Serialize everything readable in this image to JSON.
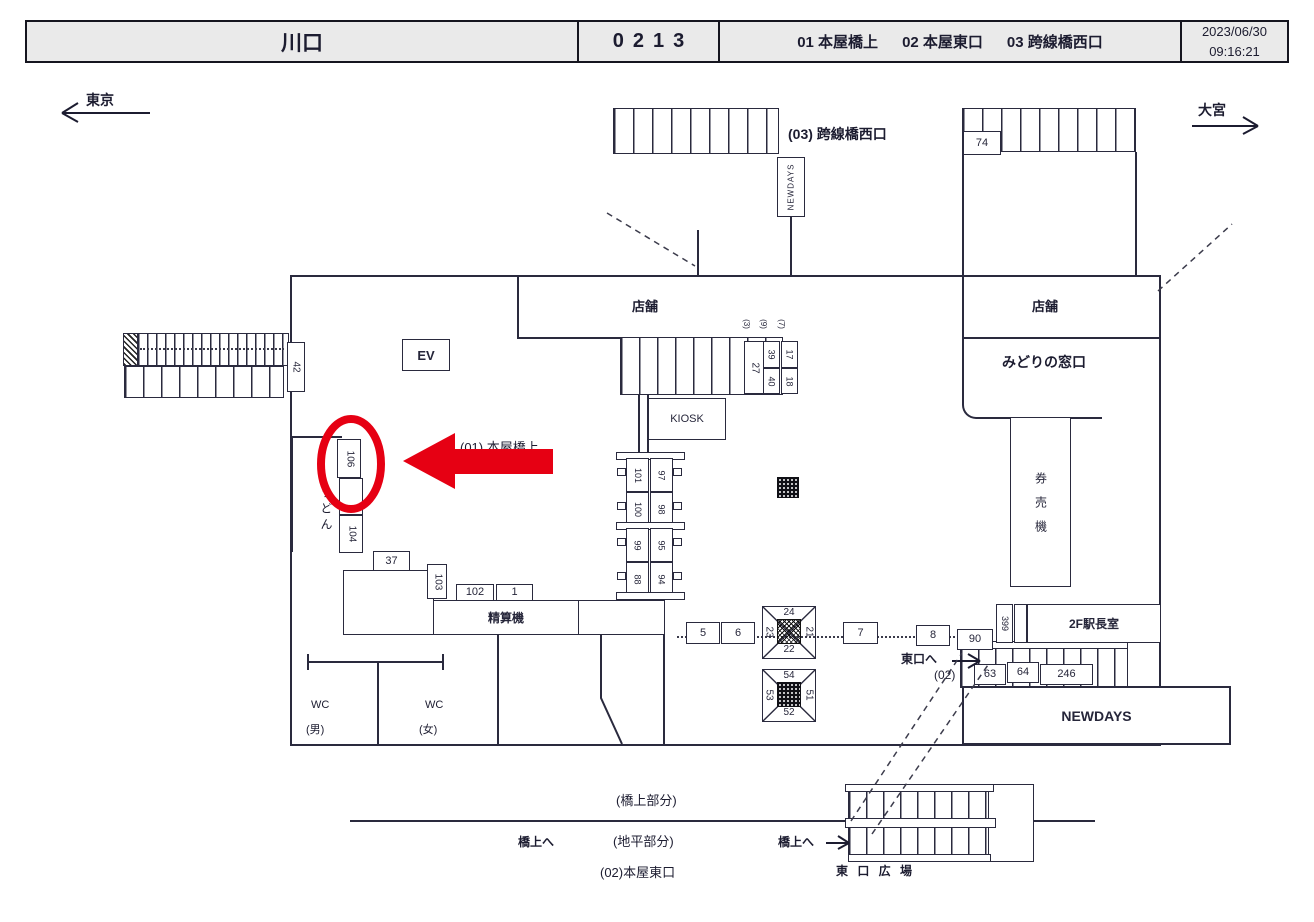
{
  "header": {
    "station": "川口",
    "code": "0213",
    "areas": [
      "01 本屋橋上",
      "02 本屋東口",
      "03 跨線橋西口"
    ],
    "date": "2023/06/30",
    "time": "09:16:21"
  },
  "directions": {
    "left": "東京",
    "right": "大宮"
  },
  "labels": {
    "kosenkyo": "(03) 跨線橋西口",
    "honya": "(01) 本屋橋上",
    "shop_left": "店舗",
    "shop_right": "店舗",
    "midori": "みどりの窓口",
    "kenbaiki": "券売機",
    "kiosk": "KIOSK",
    "ev": "EV",
    "seisanki": "精算機",
    "newdays_top": "NEWDAYS",
    "newdays_main": "NEWDAYS",
    "ekicho": "2F駅長室",
    "udon": "うどん",
    "wc": "WC",
    "wc_male": "(男)",
    "wc_female": "(女)",
    "to_east": "東口へ",
    "to_east_code": "(02)",
    "bridge_part": "(橋上部分)",
    "ground_part": "(地平部分)",
    "honya_east": "(02)本屋東口",
    "to_bridge": "橋上へ",
    "east_plaza": "東 口 広 場"
  },
  "signs": {
    "s42": "42",
    "s74": "74",
    "s106": "106",
    "s104": "104",
    "s37": "37",
    "s103": "103",
    "s102": "102",
    "s1": "1",
    "s27": "27",
    "s39": "39",
    "s40": "40",
    "s17": "17",
    "s18": "18",
    "s101": "101",
    "s97": "97",
    "s100": "100",
    "s98": "98",
    "s99": "99",
    "s95": "95",
    "s88": "88",
    "s94": "94",
    "s5": "5",
    "s6": "6",
    "s7": "7",
    "s8": "8",
    "s90": "90",
    "s399": "399",
    "s63": "63",
    "s64": "64",
    "s246": "246",
    "tiny": [
      "(3)",
      "(9)",
      "(7)"
    ],
    "x1": {
      "top": "24",
      "left": "23",
      "right": "21",
      "bottom": "22"
    },
    "x2": {
      "top": "54",
      "left": "53",
      "right": "51",
      "bottom": "52"
    }
  },
  "colors": {
    "highlight": "#e60013",
    "header_bg": "#eaeaea",
    "line": "#2a2a3e"
  }
}
